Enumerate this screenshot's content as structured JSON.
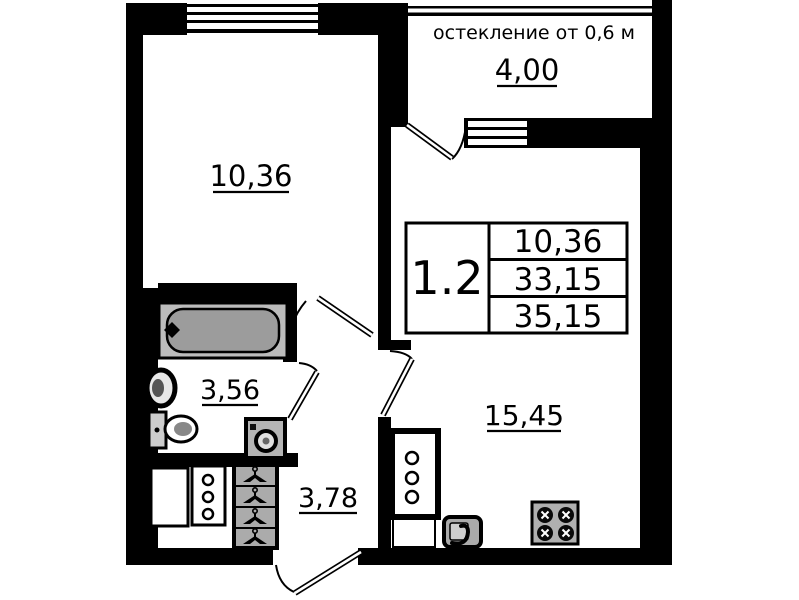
{
  "document": {
    "kind": "apartment floor plan"
  },
  "colors": {
    "wall": "#000000",
    "tub_rim": "#bcbcbc",
    "tub_inner": "#9c9c9c",
    "wardrobe_gray": "#ababab",
    "appliance_gray": "#b0b0b0"
  },
  "balcony": {
    "note": "остекление от 0,6 м",
    "area": "4,00"
  },
  "rooms": {
    "living": {
      "area": "10,36"
    },
    "bathroom": {
      "area": "3,56"
    },
    "hallway": {
      "area": "3,78"
    },
    "kitchen_living": {
      "area": "15,45"
    }
  },
  "info_table": {
    "unit": "1.2",
    "rows": [
      "10,36",
      "33,15",
      "35,15"
    ]
  }
}
